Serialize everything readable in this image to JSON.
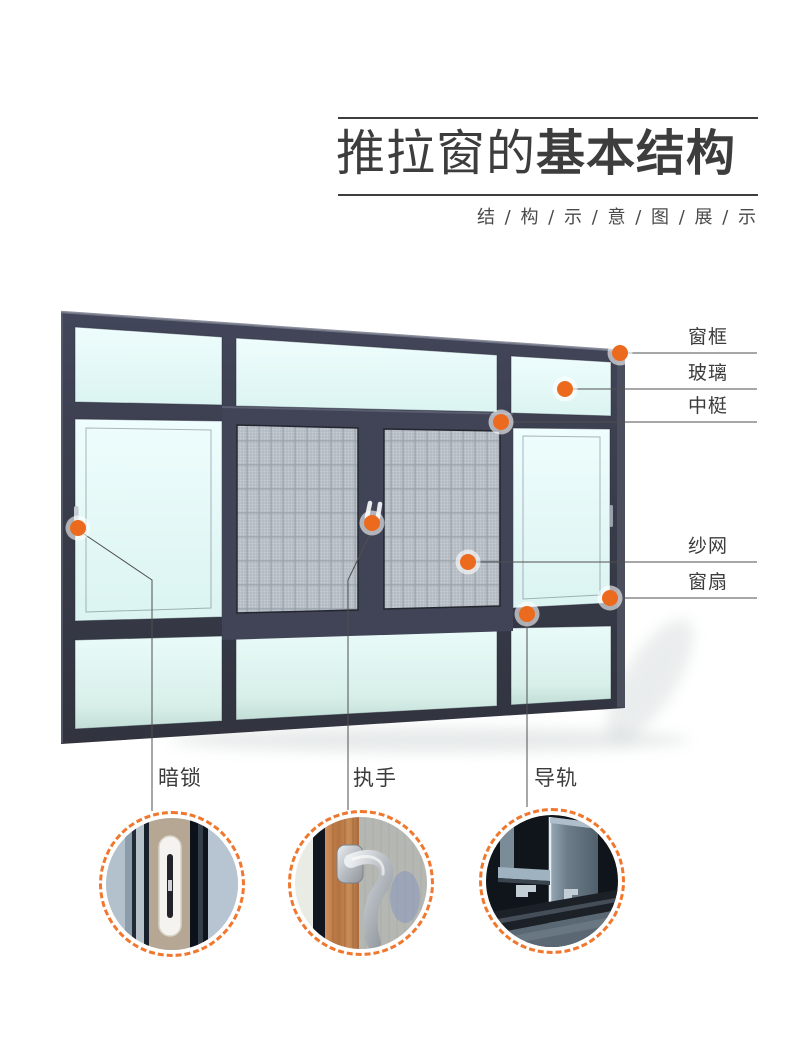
{
  "header": {
    "title_regular": "推拉窗的",
    "title_bold": "基本结构",
    "subtitle": "结 / 构 / 示 / 意 / 图 / 展 / 示"
  },
  "colors": {
    "accent_orange": "#ec6a1d",
    "dashed_ring_orange": "#f0772e",
    "frame_dark": "#3a3d4b",
    "glass_light": "#e9fcfb",
    "mesh_gray": "#c7ccd3",
    "text_dark": "#3c3c3c"
  },
  "callouts_right": [
    {
      "label": "窗框"
    },
    {
      "label": "玻璃"
    },
    {
      "label": "中梃"
    },
    {
      "label": "纱网"
    },
    {
      "label": "窗扇"
    }
  ],
  "callouts_bottom": [
    {
      "label": "暗锁"
    },
    {
      "label": "执手"
    },
    {
      "label": "导轨"
    }
  ]
}
